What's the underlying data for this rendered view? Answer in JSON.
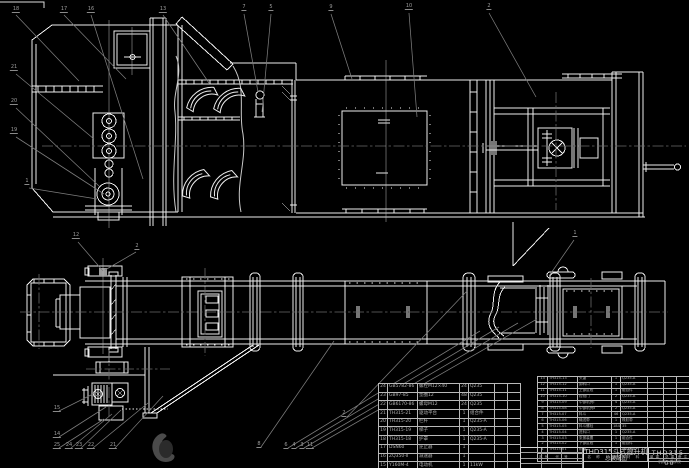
{
  "colors": {
    "background": "#000000",
    "line": "#ededed",
    "leader": "#7d7d7d",
    "centerline": "#6a6a6a",
    "callout_text": "#9c9c9c",
    "table_text": "#b0b0b0"
  },
  "title_block": {
    "product": "THD315斗式提升机",
    "sheet": "总装配图",
    "drawing_no": "THD315-00",
    "org": "机械工程学院"
  },
  "bom": {
    "header": [
      "序号",
      "代 号",
      "名 称",
      "数量",
      "材 料",
      "单重",
      "总重",
      "备注"
    ],
    "right_rows": [
      [
        "13",
        "TH315-13",
        "头罩",
        "1",
        "Q235-A",
        "",
        "",
        ""
      ],
      [
        "12",
        "TH315-12",
        "卸料口",
        "1",
        "Q235-A",
        "",
        "",
        ""
      ],
      [
        "11",
        "TH315-11",
        "上部区段",
        "1",
        "组合件",
        "",
        "",
        ""
      ],
      [
        "10",
        "TH315-10",
        "检视门",
        "2",
        "Q235-A",
        "",
        "",
        ""
      ],
      [
        "9",
        "TH315-09",
        "中部机壳Ⅰ",
        "4",
        "Q235-A",
        "",
        "",
        ""
      ],
      [
        "8",
        "TH315-08",
        "中部机壳Ⅱ",
        "2",
        "Q235-A",
        "",
        "",
        ""
      ],
      [
        "7",
        "TH315-07",
        "料斗",
        "46",
        "Q235-A",
        "",
        "",
        ""
      ],
      [
        "6",
        "TH315-06",
        "输送带",
        "1",
        "橡胶带",
        "",
        "",
        ""
      ],
      [
        "5",
        "TH315-05",
        "料斗螺栓",
        "184",
        "35",
        "",
        "",
        ""
      ],
      [
        "4",
        "TH315-04",
        "进料口",
        "1",
        "Q235-A",
        "",
        "",
        ""
      ],
      [
        "3",
        "TH315-03",
        "张紧装置",
        "1",
        "组合件",
        "",
        "",
        ""
      ],
      [
        "2",
        "TH315-02",
        "下部区段",
        "1",
        "组合件",
        "",
        "",
        ""
      ],
      [
        "1",
        "TH315-01",
        "机座",
        "1",
        "Q235-A",
        "",
        "",
        ""
      ]
    ],
    "left_rows": [
      [
        "24",
        "GB5782-86",
        "螺栓M12×40",
        "24",
        "Q235",
        "",
        ""
      ],
      [
        "23",
        "GB97-85",
        "垫圈12",
        "48",
        "Q235",
        "",
        ""
      ],
      [
        "22",
        "GB6170-86",
        "螺母M12",
        "24",
        "Q235",
        "",
        ""
      ],
      [
        "21",
        "TH315-21",
        "驱动平台",
        "1",
        "组合件",
        "",
        ""
      ],
      [
        "20",
        "TH315-20",
        "栏杆",
        "1",
        "Q235-A",
        "",
        ""
      ],
      [
        "19",
        "TH315-19",
        "梯子",
        "1",
        "Q235-A",
        "",
        ""
      ],
      [
        "18",
        "TH315-18",
        "护罩",
        "1",
        "Q235-A",
        "",
        ""
      ],
      [
        "17",
        "DSN60",
        "逆止器",
        "1",
        "",
        "",
        ""
      ],
      [
        "16",
        "ZQ350-Ⅱ",
        "减速器",
        "1",
        "",
        "",
        ""
      ],
      [
        "15",
        "Y160M-4",
        "电动机",
        "1",
        "11kW",
        "",
        ""
      ],
      [
        "14",
        "TH315-14",
        "联轴器",
        "1",
        "HL3",
        "",
        ""
      ]
    ]
  },
  "callouts": [
    {
      "x": 16,
      "y": 13,
      "label": "18"
    },
    {
      "x": 64,
      "y": 13,
      "label": "17"
    },
    {
      "x": 91,
      "y": 13,
      "label": "16"
    },
    {
      "x": 163,
      "y": 13,
      "label": "13"
    },
    {
      "x": 244,
      "y": 11,
      "label": "7"
    },
    {
      "x": 271,
      "y": 11,
      "label": "5"
    },
    {
      "x": 331,
      "y": 11,
      "label": "9"
    },
    {
      "x": 409,
      "y": 10,
      "label": "10"
    },
    {
      "x": 489,
      "y": 10,
      "label": "2"
    },
    {
      "x": 14,
      "y": 71,
      "label": "21"
    },
    {
      "x": 14,
      "y": 105,
      "label": "20"
    },
    {
      "x": 14,
      "y": 134,
      "label": "19"
    },
    {
      "x": 27,
      "y": 185,
      "label": "1"
    },
    {
      "x": 76,
      "y": 239,
      "label": "12"
    },
    {
      "x": 137,
      "y": 250,
      "label": "2"
    },
    {
      "x": 575,
      "y": 237,
      "label": "1"
    },
    {
      "x": 57,
      "y": 412,
      "label": "15"
    },
    {
      "x": 57,
      "y": 438,
      "label": "14"
    },
    {
      "x": 57,
      "y": 449,
      "label": "25"
    },
    {
      "x": 69,
      "y": 449,
      "label": "24"
    },
    {
      "x": 79,
      "y": 449,
      "label": "23"
    },
    {
      "x": 91,
      "y": 449,
      "label": "22"
    },
    {
      "x": 113,
      "y": 449,
      "label": "21"
    },
    {
      "x": 259,
      "y": 448,
      "label": "8"
    },
    {
      "x": 286,
      "y": 449,
      "label": "6"
    },
    {
      "x": 294,
      "y": 449,
      "label": "4"
    },
    {
      "x": 302,
      "y": 449,
      "label": "3"
    },
    {
      "x": 310,
      "y": 449,
      "label": "11"
    },
    {
      "x": 344,
      "y": 417,
      "label": "2"
    }
  ]
}
